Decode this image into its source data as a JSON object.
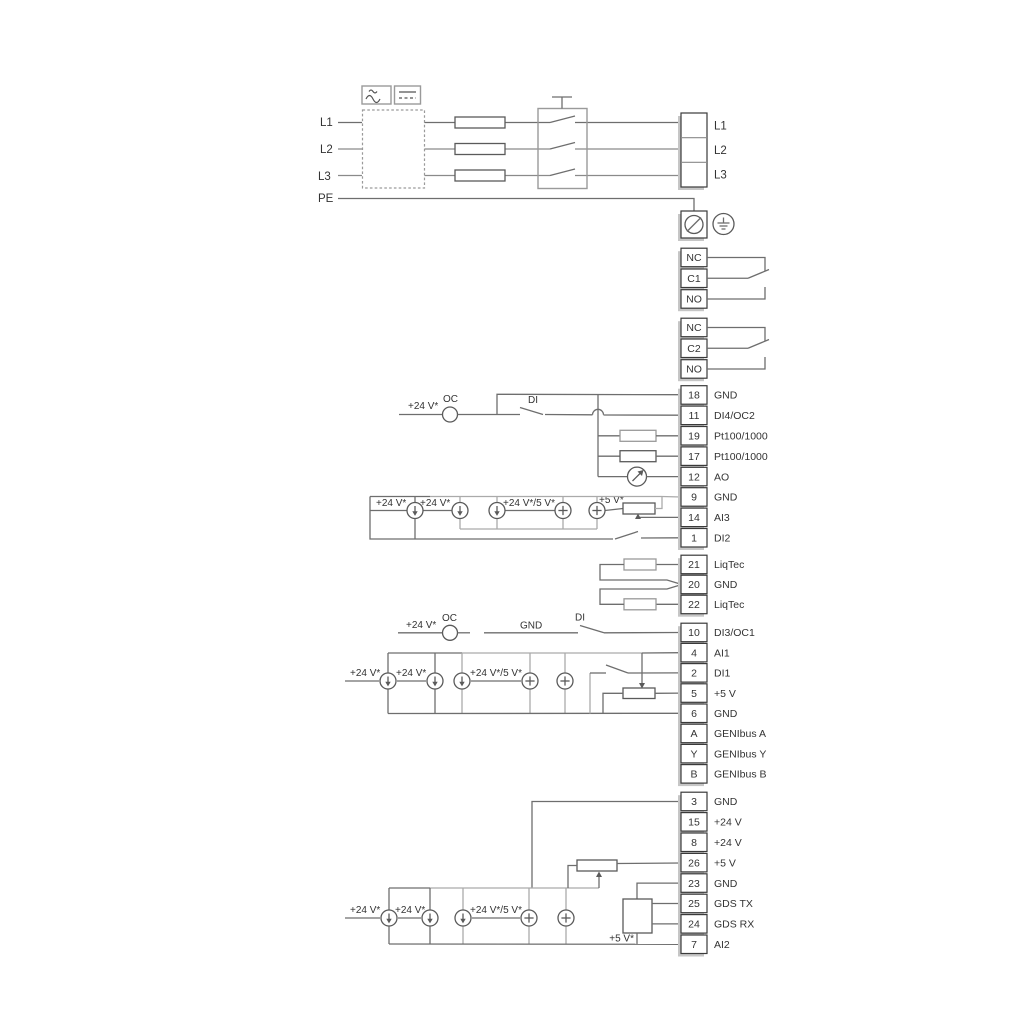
{
  "colors": {
    "background": "#ffffff",
    "wire": "#6e6e6e",
    "wire_alt": "#aaaaaa",
    "component": "#5a5a5a",
    "cell_border": "#3a3a3a",
    "strip_shadow": "#c6c6c6",
    "text": "#333333"
  },
  "mains": {
    "in": [
      "L1",
      "L2",
      "L3",
      "PE"
    ],
    "out": [
      "L1",
      "L2",
      "L3"
    ]
  },
  "relay1": [
    "NC",
    "C1",
    "NO"
  ],
  "relay2": [
    "NC",
    "C2",
    "NO"
  ],
  "strip1": [
    {
      "n": "18",
      "l": "GND"
    },
    {
      "n": "11",
      "l": "DI4/OC2"
    },
    {
      "n": "19",
      "l": "Pt100/1000"
    },
    {
      "n": "17",
      "l": "Pt100/1000"
    },
    {
      "n": "12",
      "l": "AO"
    },
    {
      "n": "9",
      "l": "GND"
    },
    {
      "n": "14",
      "l": "AI3"
    },
    {
      "n": "1",
      "l": "DI2"
    }
  ],
  "liqtec": [
    {
      "n": "21",
      "l": "LiqTec"
    },
    {
      "n": "20",
      "l": "GND"
    },
    {
      "n": "22",
      "l": "LiqTec"
    }
  ],
  "strip2": [
    {
      "n": "10",
      "l": "DI3/OC1"
    },
    {
      "n": "4",
      "l": "AI1"
    },
    {
      "n": "2",
      "l": "DI1"
    },
    {
      "n": "5",
      "l": "+5 V"
    },
    {
      "n": "6",
      "l": "GND"
    },
    {
      "n": "A",
      "l": "GENIbus A"
    },
    {
      "n": "Y",
      "l": "GENIbus Y"
    },
    {
      "n": "B",
      "l": "GENIbus B"
    }
  ],
  "strip3": [
    {
      "n": "3",
      "l": "GND"
    },
    {
      "n": "15",
      "l": "+24 V"
    },
    {
      "n": "8",
      "l": "+24 V"
    },
    {
      "n": "26",
      "l": "+5 V"
    },
    {
      "n": "23",
      "l": "GND"
    },
    {
      "n": "25",
      "l": "GDS TX"
    },
    {
      "n": "24",
      "l": "GDS RX"
    },
    {
      "n": "7",
      "l": "AI2"
    }
  ],
  "ann": {
    "v24": "+24 V*",
    "v245": "+24 V*/5 V*",
    "v5": "+5 V*",
    "oc": "OC",
    "di": "DI",
    "gnd": "GND"
  }
}
